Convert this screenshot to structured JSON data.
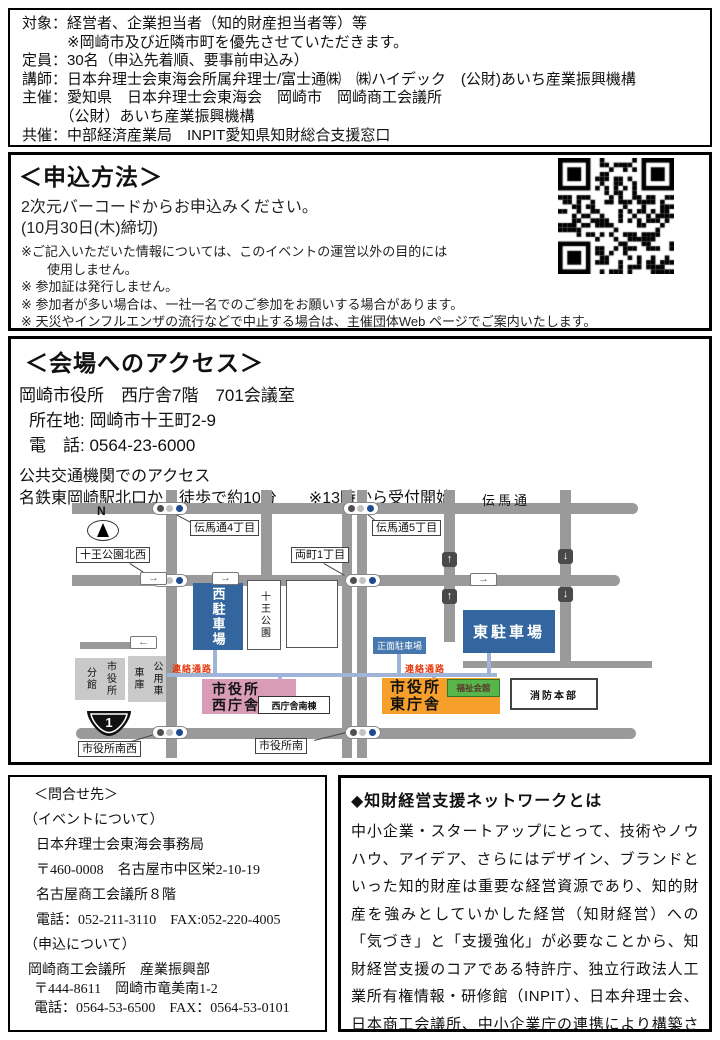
{
  "header": {
    "lines": [
      "対象：経営者、企業担当者（知的財産担当者等）等",
      "　　　※岡崎市及び近隣市町を優先させていただきます。",
      "定員：30名（申込先着順、要事前申込み）",
      "講師：日本弁理士会東海会所属弁理士/富士通㈱　㈱ハイデック　(公財)あいち産業振興機構",
      "主催：愛知県　日本弁理士会東海会　岡崎市　岡崎商工会議所",
      "　　　（公財）あいち産業振興機構",
      "共催：中部経済産業局　INPIT愛知県知財総合支援窓口"
    ]
  },
  "application": {
    "title": "＜申込方法＞",
    "line1": "2次元バーコードからお申込みください。",
    "line2": "(10月30日(木)締切)",
    "notes": [
      "※ご記入いただいた情報については、このイベントの運営以外の目的には",
      "　　使用しません。",
      "※ 参加証は発行しません。",
      "※ 参加者が多い場合は、一社一名でのご参加をお願いする場合があります。",
      "※ 天災やインフルエンザの流行などで中止する場合は、主催団体Web ページでご案内いたします。"
    ]
  },
  "access": {
    "title": "＜会場へのアクセス＞",
    "venue": "岡崎市役所　西庁舎7階　701会議室",
    "address": "所在地: 岡崎市十王町2-9",
    "phone": "電　話: 0564-23-6000",
    "transit_heading": "公共交通機関でのアクセス",
    "transit_detail": "名鉄東岡崎駅北口から徒歩で約10分　　※13時から受付開始"
  },
  "map": {
    "street_name": "伝馬通",
    "compass": "N",
    "route_number": "1",
    "walkway": "連絡通路",
    "icons": {
      "right": "→",
      "up": "↑",
      "down": "↓",
      "left": "←"
    },
    "signals": {
      "temma4": "伝馬通4丁目",
      "temma5": "伝馬通5丁目",
      "juo_nw": "十王公園北西",
      "ryomachi1": "両町1丁目",
      "shiyakusho_sw": "市役所南西",
      "shiyakusho_s": "市役所南"
    },
    "buildings": {
      "west_parking": "西駐車場",
      "juo_park": "十王公園",
      "east_parking": "東駐車場",
      "front_parking": "正面駐車場",
      "west_office_1": "市役所",
      "west_office_2": "西庁舎",
      "west_annex": "西庁舎南棟",
      "east_office_1": "市役所",
      "east_office_2": "東庁舎",
      "welfare": "福祉会館",
      "fire_hq": "消防本部",
      "bunkan": "分館",
      "shiyakusho": "市役所",
      "shako": "車庫",
      "koyosha": "公用車"
    },
    "colors": {
      "parking_blue": "#33669e",
      "front_parking_blue": "#4677ae",
      "west_office_pink": "#d89cb6",
      "east_office_orange": "#f6a02b",
      "welfare_green": "#57b54a",
      "road_gray": "#9a9a9a",
      "walkway_blue": "#9fb4d6",
      "gray_building": "#c9c9c9",
      "red_label": "#e8380d"
    }
  },
  "contact": {
    "title": "＜問合せ先＞",
    "event_heading": "（イベントについて）",
    "event_org": "日本弁理士会東海会事務局",
    "event_address1": "〒460-0008　名古屋市中区栄2-10-19",
    "event_address2": "名古屋商工会議所８階",
    "event_tel": "電話：052-211-3110　FAX:052-220-4005",
    "apply_heading": "（申込について）",
    "apply_org": "岡崎商工会議所　産業振興部",
    "apply_address": "〒444-8611　岡崎市竜美南1-2",
    "apply_tel": "電話：0564-53-6500　FAX：0564-53-0101"
  },
  "network": {
    "title": "◆知財経営支援ネットワークとは",
    "body": "中小企業・スタートアップにとって、技術やノウハウ、アイデア、さらにはデザイン、ブランドといった知的財産は重要な経営資源であり、知的財産を強みとしていかした経営（知財経営）への「気づき」と「支援強化」が必要なことから、知財経営支援のコアである特許庁、独立行政法人工業所有権情報・研修館（INPIT）、日本弁理士会、日本商工会議所、中小企業庁の連携により構築されたネットワークのこと。"
  }
}
